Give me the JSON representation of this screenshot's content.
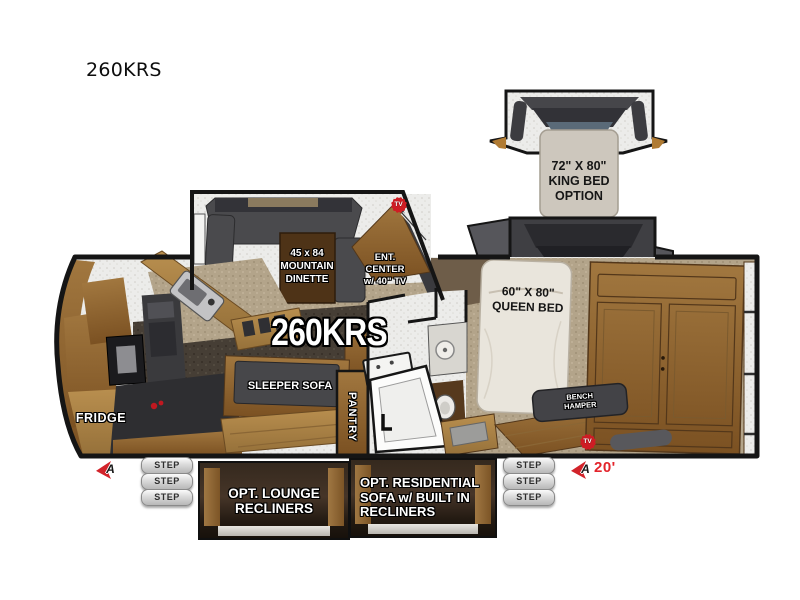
{
  "title": "260KRS",
  "floorplan": {
    "model": "260KRS",
    "dinette": {
      "l1": "45 x 84",
      "l2": "MOUNTAIN",
      "l3": "DINETTE"
    },
    "ent_center": {
      "l1": "ENT.",
      "l2": "CENTER",
      "l3": "w/ 40\" TV"
    },
    "sleeper_sofa": "SLEEPER SOFA",
    "pantry": "PANTRY",
    "fridge": "FRIDGE",
    "queen_bed": {
      "l1": "60\" X 80\"",
      "l2": "QUEEN BED"
    },
    "king_bed_option": {
      "l1": "72\" X 80\"",
      "l2": "KING BED",
      "l3": "OPTION"
    },
    "bench_hamper": {
      "l1": "BENCH",
      "l2": "HAMPER"
    },
    "tv_badge": "TV",
    "awning": {
      "marker": "A",
      "length": "20'"
    },
    "step_label": "STEP",
    "options": {
      "lounge": {
        "l1": "OPT. LOUNGE",
        "l2": "RECLINERS"
      },
      "residential": {
        "l1": "OPT. RESIDENTIAL",
        "l2": "SOFA w/ BUILT IN",
        "l3": "RECLINERS"
      }
    },
    "colors": {
      "accent_red": "#d2232a",
      "wood": "#96713d",
      "wall": "#151515",
      "carpet": "#b3a48a",
      "slide_gray": "#3f3f43",
      "label_white": "#ffffff"
    }
  }
}
